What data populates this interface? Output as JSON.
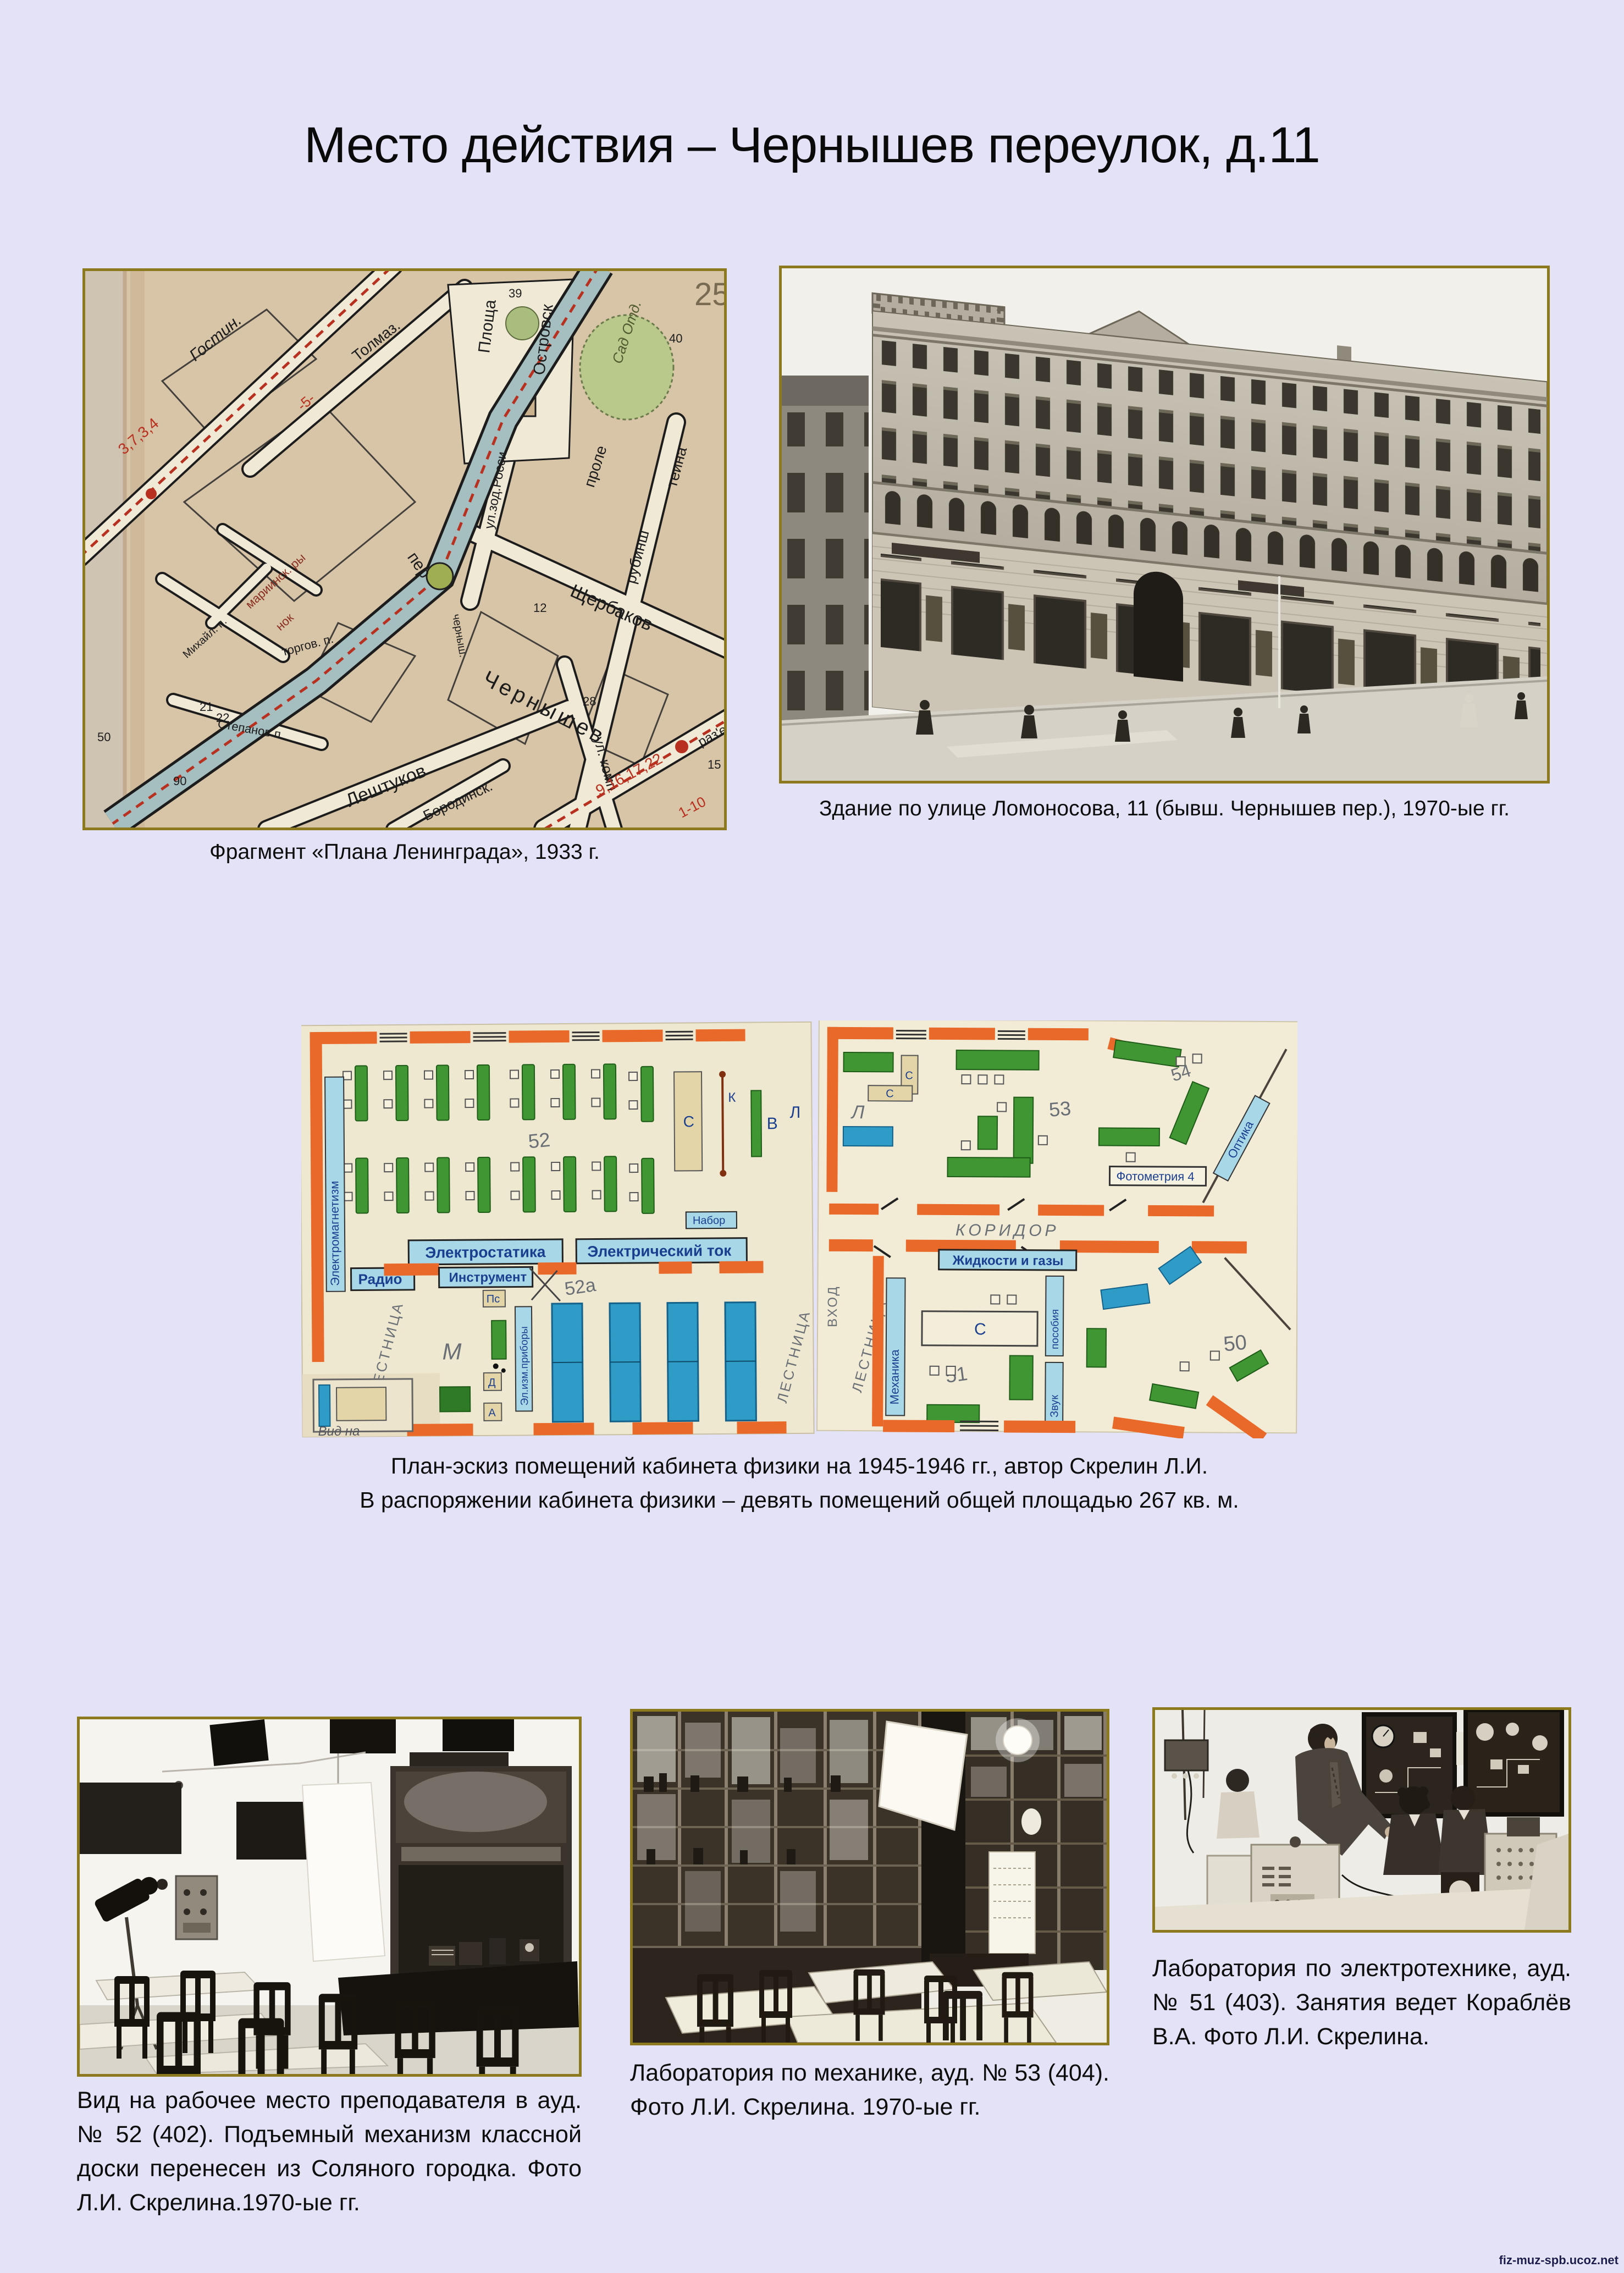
{
  "page": {
    "title": "Место действия – Чернышев переулок, д.11",
    "watermark": "fiz-muz-spb.ucoz.net"
  },
  "colors": {
    "background": "#e3e2f6",
    "photo_frame": "#8d7a1f",
    "map_paper": "#d8c4a6",
    "map_water": "#a5bec0",
    "map_route_red": "#b8301f",
    "plan_wall_orange": "#e8692a",
    "plan_desk_green": "#3f9632",
    "plan_table_blue": "#2e9cc7"
  },
  "map_figure": {
    "caption": "Фрагмент «Плана Ленинграда», 1933 г.",
    "labels": {
      "gostin": "Гостин.",
      "tolmaz": "Толмаз.",
      "ploshcha": "Площа",
      "ostrovsk": "Островск",
      "zod_rossi": "ул.зод.Росси",
      "sad": "Сад Отд.",
      "prole": "проле",
      "teina": "теина",
      "rubinsh": "рубинш",
      "shcherbakov": "Щербаков",
      "per_small": "пер",
      "chernyshev": "Чернышев",
      "chernysh_v": "черныш.",
      "ul_komp": "ул. комп",
      "leshtukov": "Лештуков",
      "borodinsk": "Бородинск.",
      "mariinsk": "мариинск. ры",
      "nok": "нок",
      "torgov": "торгов. п.",
      "stepanov": "Степанов п.",
      "mikhail": "Михайл. п.",
      "razye": "раз'е",
      "route_a": "3,7,3,4",
      "route_b": "9,16,17,22",
      "route_c": "1-10",
      "route_d": "-5-",
      "n39": "39",
      "n40": "40",
      "n12": "12",
      "n28": "28",
      "n90": "90",
      "n50": "50",
      "n21": "21",
      "n22": "22",
      "n15": "15",
      "n25": "25"
    }
  },
  "building_figure": {
    "caption": "Здание по улице Ломоносова, 11 (бывш. Чернышев пер.), 1970-ые гг."
  },
  "floorplan_figure": {
    "caption_line1": "План-эскиз помещений кабинета физики на 1945-1946 гг., автор Скрелин Л.И.",
    "caption_line2": "В распоряжении кабинета физики – девять помещений общей площадью 267 кв. м.",
    "labels": {
      "room52": "52",
      "room52a": "52а",
      "room53": "53",
      "room54": "54",
      "room51": "51",
      "room50": "50",
      "roomL": "Л",
      "m": "М",
      "v": "В",
      "s": "С",
      "k": "К",
      "d": "Д",
      "a": "А",
      "ps": "Пс",
      "koridor": "КОРИДОР",
      "lestnitsa": "ЛЕСТНИЦА",
      "vkhod": "ВХОД",
      "elektrostatika": "Электростатика",
      "tok": "Электрический ток",
      "radio": "Радио",
      "instrument": "Инструмент",
      "el_izm": "Эл.изм.приборы",
      "zhidkosti": "Жидкости и газы",
      "fotometriya": "Фотометрия 4",
      "optika": "Оптика",
      "mekhanika": "Механика",
      "zvuk": "Звук",
      "posobiya": "пособия",
      "nabor": "Набор",
      "vid_na": "Вид на",
      "elektromagnetizm": "Электромагнетизм"
    }
  },
  "classroom_figure": {
    "caption": "Вид на рабочее место преподавателя в ауд. № 52 (402). Подъемный механизм классной доски перенесен из Соляного городка. Фото Л.И. Скрелина.1970-ые гг."
  },
  "mechanics_figure": {
    "caption": "Лаборатория по механике, ауд. № 53 (404). Фото Л.И. Скрелина. 1970-ые гг."
  },
  "electro_figure": {
    "caption": "Лаборатория по электротехнике, ауд. № 51 (403). Занятия ведет Кораблёв В.А. Фото Л.И. Скрелина."
  }
}
